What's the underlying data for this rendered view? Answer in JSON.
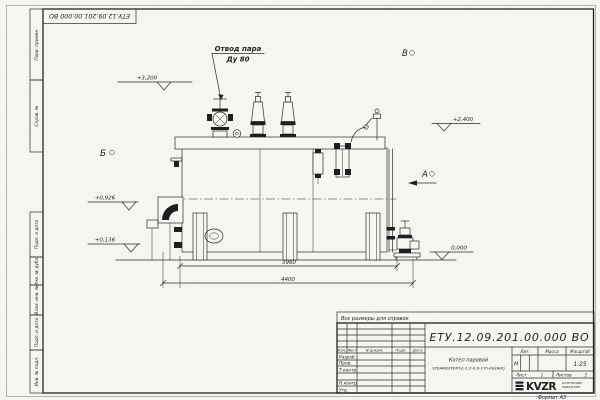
{
  "colors": {
    "line": "#2b2b2b",
    "paper": "#f4f4f1"
  },
  "corner_stamp": {
    "code": "ЕТУ.12.09.201.00.000 ВО"
  },
  "margin_labels": {
    "top": [
      "Перв. примен.",
      "Справ. №"
    ],
    "bottom": [
      "Подп. и дата",
      "Инв. № дубл.",
      "Взам. инв. №",
      "Подп. и дата",
      "Инв. № подл."
    ]
  },
  "drawing": {
    "steam_callout_line1": "Отвод пара",
    "steam_callout_line2": "Ду 80",
    "view_b": "Б",
    "view_v": "В",
    "view_a": "А",
    "elev_3200": "+3,200",
    "elev_2400": "+2,400",
    "elev_0926": "+0,926",
    "elev_0136": "+0,136",
    "elev_0000": "0,000",
    "dim_inner": "3960",
    "dim_overall": "4400"
  },
  "note": {
    "text": "Все размеры для справок"
  },
  "title_block": {
    "doc_number": "ЕТУ.12.09.201.00.000  ВО",
    "change_header": {
      "izm": "Изм.",
      "list": "Лист",
      "ndoc": "N докум.",
      "podp": "Подп.",
      "data": "Дата"
    },
    "roles": [
      "Разраб.",
      "Пров.",
      "Т.контр.",
      "Н.контр.",
      "Утв."
    ],
    "product_name": "Котел паровой",
    "product_model": "STEAMEXPERT-E-1,2-0,9-170-КБ(ЖК)",
    "lit_label": "Лит.",
    "lit_value": "М",
    "mass_label": "Масса",
    "scale_label": "Масштаб",
    "scale_value": "1:25",
    "sheet_label": "Лист",
    "sheet_value": "1",
    "sheets_label": "Листов",
    "sheets_value": "2",
    "logo": "KVZR",
    "logo_caption1": "КОТЕЛЬНЫЙ",
    "logo_caption2": "ЗАВОД РЭП",
    "format": "Формат А3"
  }
}
